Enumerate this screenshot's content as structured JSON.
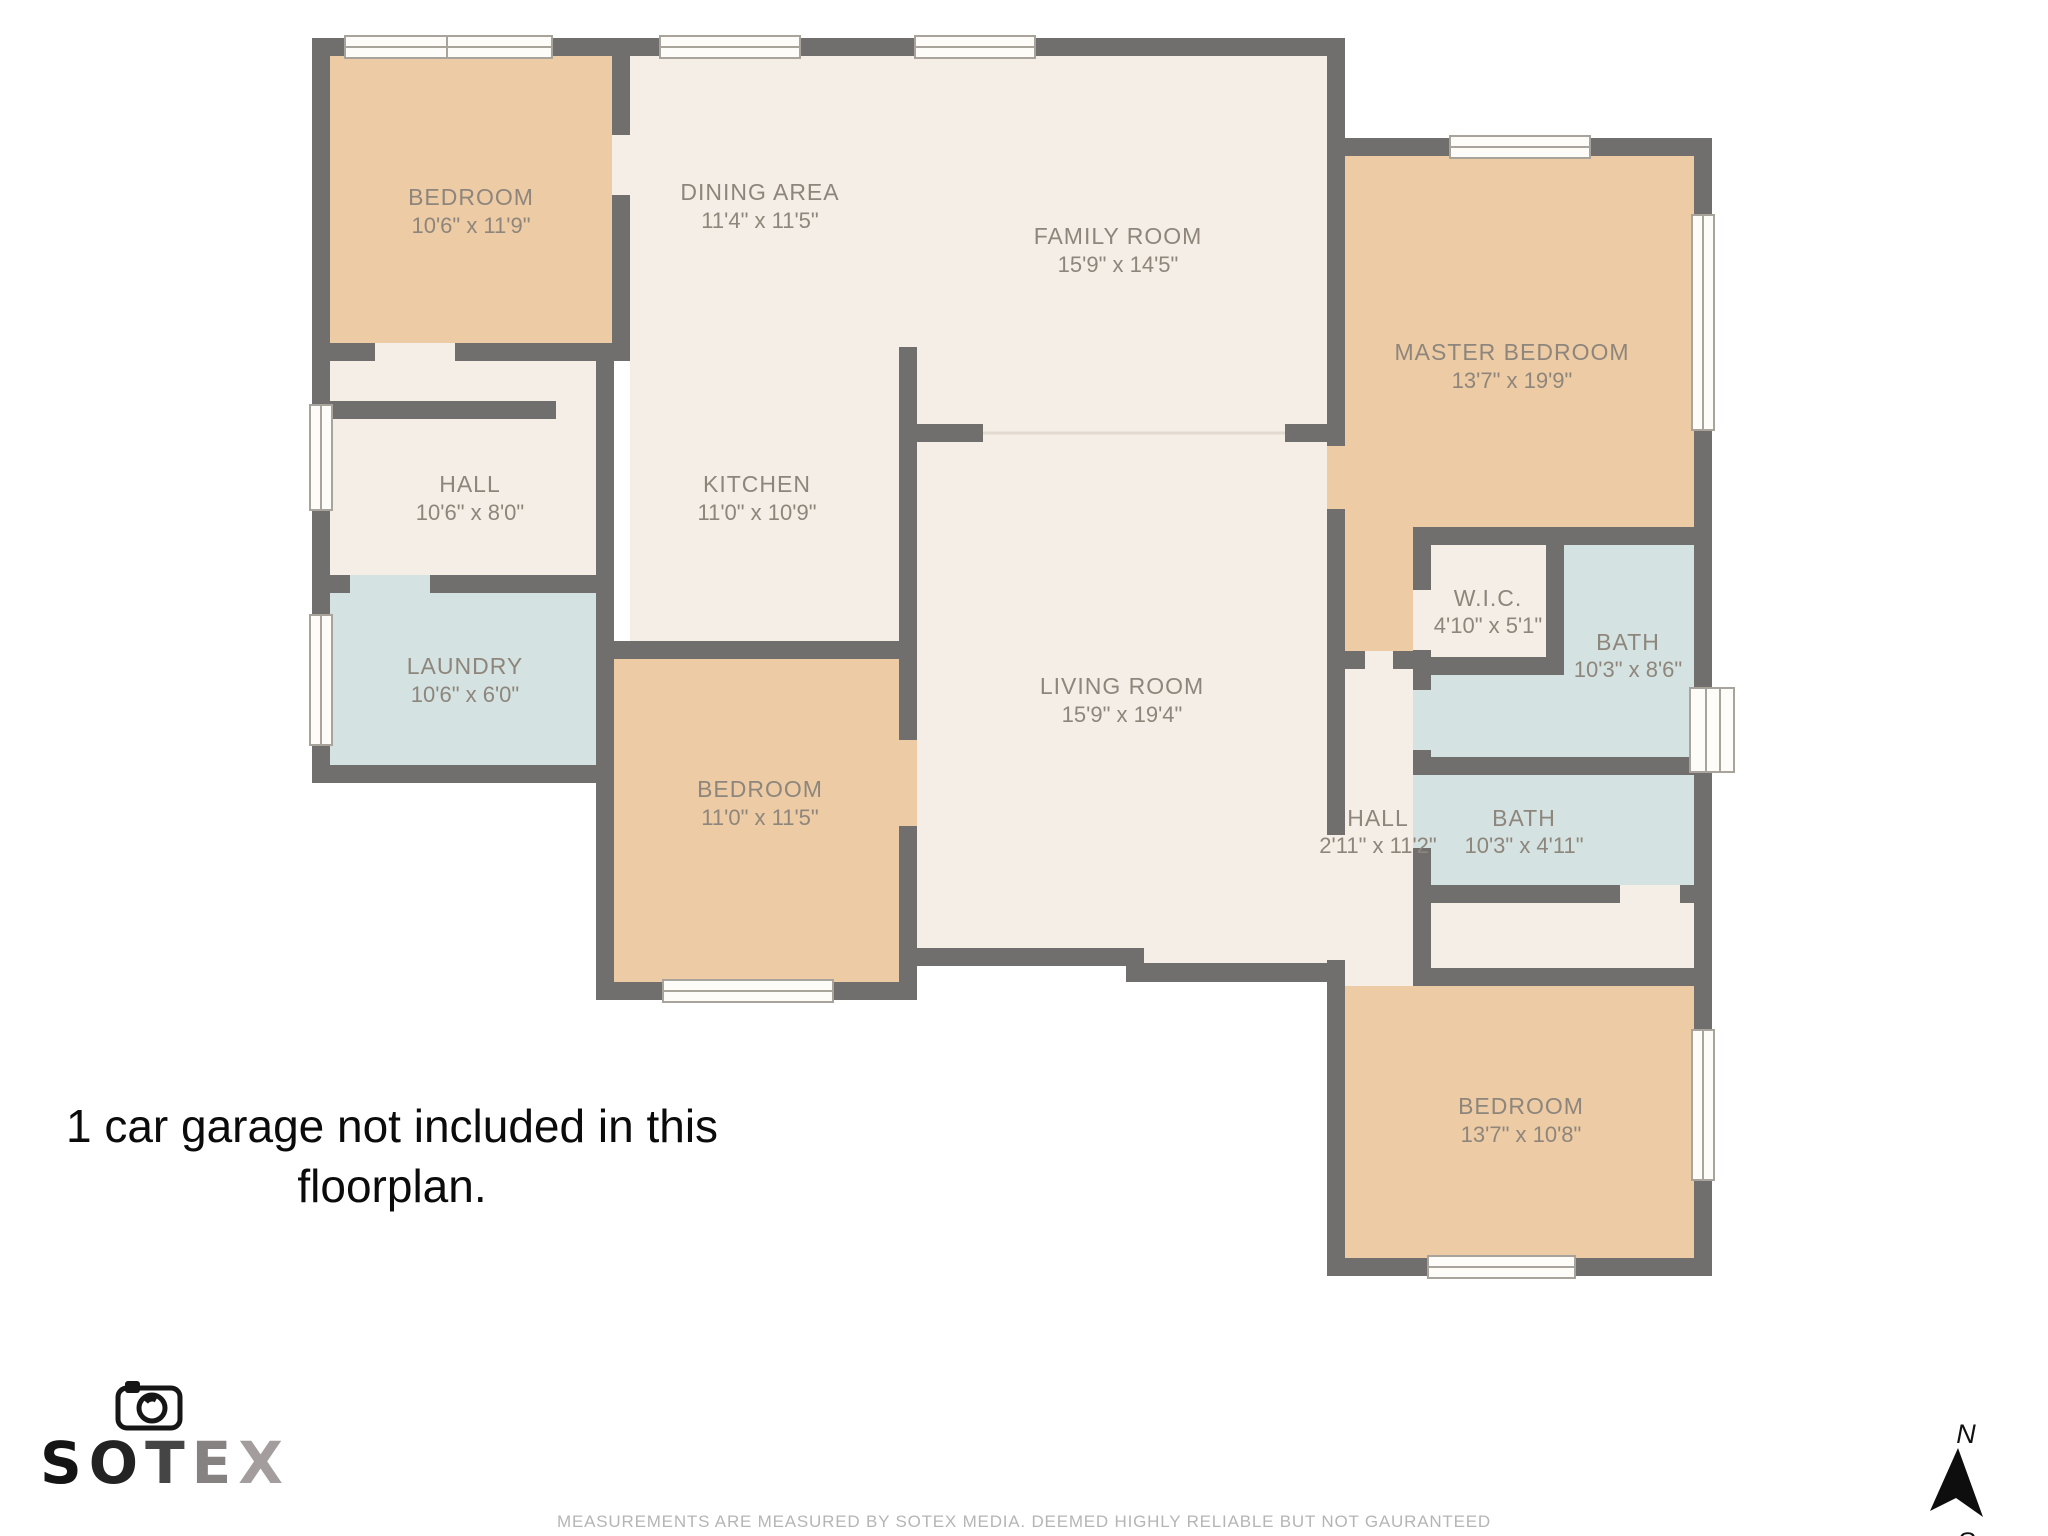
{
  "floorplan": {
    "rooms": [
      {
        "id": "bedroom-top-left",
        "name": "BEDROOM",
        "dims": "10'6\" x 11'9\""
      },
      {
        "id": "dining-area",
        "name": "DINING AREA",
        "dims": "11'4\" x 11'5\""
      },
      {
        "id": "family-room",
        "name": "FAMILY ROOM",
        "dims": "15'9\" x 14'5\""
      },
      {
        "id": "master-bedroom",
        "name": "MASTER BEDROOM",
        "dims": "13'7\" x 19'9\""
      },
      {
        "id": "hall-left",
        "name": "HALL",
        "dims": "10'6\" x 8'0\""
      },
      {
        "id": "kitchen",
        "name": "KITCHEN",
        "dims": "11'0\" x 10'9\""
      },
      {
        "id": "laundry",
        "name": "LAUNDRY",
        "dims": "10'6\" x 6'0\""
      },
      {
        "id": "bedroom-bottom-left",
        "name": "BEDROOM",
        "dims": "11'0\" x 11'5\""
      },
      {
        "id": "living-room",
        "name": "LIVING ROOM",
        "dims": "15'9\" x 19'4\""
      },
      {
        "id": "walk-in-closet",
        "name": "W.I.C.",
        "dims": "4'10\" x 5'1\""
      },
      {
        "id": "bath-upper",
        "name": "BATH",
        "dims": "10'3\" x 8'6\""
      },
      {
        "id": "hall-right",
        "name": "HALL",
        "dims": "2'11\" x 11'2\""
      },
      {
        "id": "bath-lower",
        "name": "BATH",
        "dims": "10'3\" x 4'11\""
      },
      {
        "id": "bedroom-bottom-right",
        "name": "BEDROOM",
        "dims": "13'7\" x 10'8\""
      }
    ],
    "icons": {
      "camera": "camera-icon",
      "north_arrow": "north-arrow-icon",
      "window": "window-icon"
    }
  },
  "note": {
    "line1": "1 car garage not included in this",
    "line2": "floorplan."
  },
  "branding": {
    "letters": [
      "S",
      "O",
      "T",
      "E",
      "X"
    ],
    "letter_colors": [
      "#141414",
      "#232323",
      "#454545",
      "#878282",
      "#a39d9d"
    ]
  },
  "compass": {
    "north_label": "N",
    "south_label": "S"
  },
  "footer": {
    "disclaimer": "MEASUREMENTS ARE MEASURED BY SOTEX MEDIA. DEEMED HIGHLY RELIABLE BUT NOT GAURANTEED"
  },
  "palette": {
    "wall": "#706f6d",
    "bedroom_fill": "#edcba5",
    "common_fill": "#f4eee6",
    "wet_room_fill": "#d4e2e1",
    "label_text": "#8e867c",
    "note_text": "#0b0b0b",
    "footer_text": "#b5b5b5"
  }
}
